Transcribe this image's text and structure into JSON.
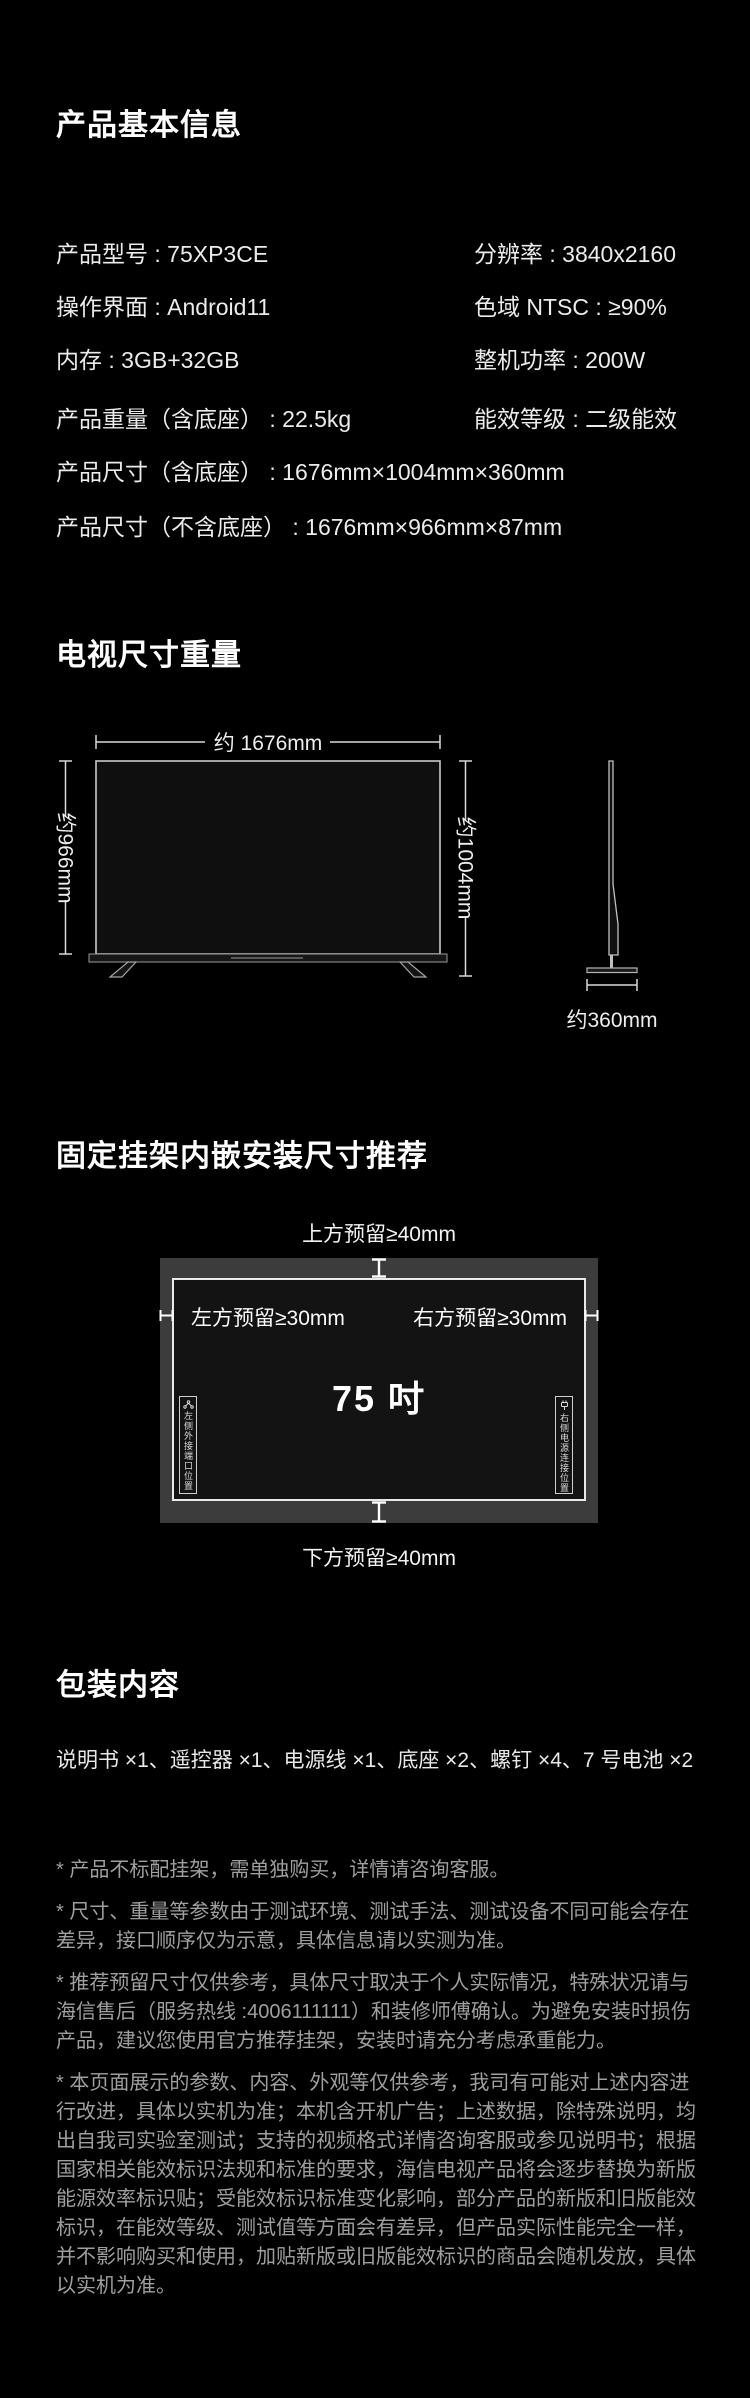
{
  "colors": {
    "background": "#000000",
    "panel_gray": "#3c3c3c",
    "heading_text": "#ffffff",
    "body_text": "#ebebeb",
    "muted_text": "#9f9f9f"
  },
  "ui": {
    "colon": " : "
  },
  "basic_info": {
    "title": "产品基本信息",
    "rows2col": [
      {
        "l_label": "产品型号",
        "l_value": "75XP3CE",
        "r_label": "分辨率",
        "r_value": "3840x2160"
      },
      {
        "l_label": "操作界面",
        "l_value": "Android11",
        "r_label": "色域 NTSC",
        "r_value": "≥90%"
      },
      {
        "l_label": "内存",
        "l_value": "3GB+32GB",
        "r_label": "整机功率",
        "r_value": "200W"
      },
      {
        "l_label": "产品重量（含底座）",
        "l_value": "22.5kg",
        "r_label": "能效等级",
        "r_value": "二级能效"
      }
    ],
    "rows_full": [
      {
        "label": "产品尺寸（含底座）",
        "value": "1676mm×1004mm×360mm"
      },
      {
        "label": "产品尺寸（不含底座）",
        "value": "1676mm×966mm×87mm"
      }
    ]
  },
  "tv_size": {
    "title": "电视尺寸重量",
    "width_label": "约 1676mm",
    "height_no_base_label": "约966mm",
    "height_with_base_label": "约1004mm",
    "depth_label": "约360mm"
  },
  "mount": {
    "title": "固定挂架内嵌安装尺寸推荐",
    "top_label": "上方预留≥40mm",
    "bottom_label": "下方预留≥40mm",
    "left_label": "左方预留≥30mm",
    "right_label": "右方预留≥30mm",
    "size_label": "75 吋",
    "left_side_note": "左侧外接端口位置",
    "right_side_note": "右侧电源连接位置"
  },
  "package": {
    "title": "包装内容",
    "contents": "说明书 ×1、遥控器 ×1、电源线 ×1、底座 ×2、螺钉 ×4、7 号电池 ×2"
  },
  "footnotes": [
    "* 产品不标配挂架，需单独购买，详情请咨询客服。",
    "* 尺寸、重量等参数由于测试环境、测试手法、测试设备不同可能会存在差异，接口顺序仅为示意，具体信息请以实测为准。",
    "* 推荐预留尺寸仅供参考，具体尺寸取决于个人实际情况，特殊状况请与海信售后（服务热线 :4006111111）和装修师傅确认。为避免安装时损伤产品，建议您使用官方推荐挂架，安装时请充分考虑承重能力。",
    "* 本页面展示的参数、内容、外观等仅供参考，我司有可能对上述内容进行改进，具体以实机为准；本机含开机广告；上述数据，除特殊说明，均出自我司实验室测试；支持的视频格式详情咨询客服或参见说明书；根据国家相关能效标识法规和标准的要求，海信电视产品将会逐步替换为新版能源效率标识贴；受能效标识标准变化影响，部分产品的新版和旧版能效标识，在能效等级、测试值等方面会有差异，但产品实际性能完全一样，并不影响购买和使用，加贴新版或旧版能效标识的商品会随机发放，具体以实机为准。"
  ]
}
